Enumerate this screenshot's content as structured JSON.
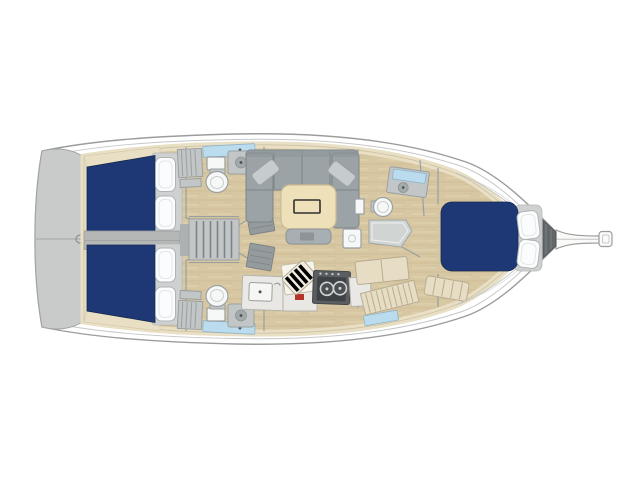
{
  "canvas": {
    "width_px": 640,
    "height_px": 479,
    "background": "#ffffff"
  },
  "colors": {
    "hull-line": "#9b9d9c",
    "deck-line": "#c6c8c7",
    "transom": "#c9cbcb",
    "transom-line": "#a2a4a4",
    "cream": "#e9dfc4",
    "cream-line": "#cdc2a3",
    "wood": "#d8c7a3",
    "wood-dark": "#c8b38b",
    "wood-light": "#e4d6b4",
    "navy": "#1d3874",
    "navy-edge": "#15294f",
    "pillow": "#fbfcfd",
    "pillow-line": "#aeb4b6",
    "gray-furn": "#c3c6c7",
    "gray-furn-line": "#9aa0a0",
    "cushion": "#9ba3a7",
    "cushion-line": "#7c8589",
    "cushion-light": "#c6cccd",
    "table": "#eee0b9",
    "table-line": "#cdbd8e",
    "white-fix": "#f6f7f7",
    "fix-line": "#9aa0a2",
    "counter": "#e9e8e4",
    "counter-line": "#b3b3ae",
    "stove": "#5a5e60",
    "stove-dark": "#3e4244",
    "stove-line": "#d2d5d6",
    "blue-glass": "#badcee",
    "blue-glass-line": "#8fb4c9",
    "beige-furn": "#e7ddc4",
    "beige-furn-line": "#b8ad92",
    "mat": "#949b9d",
    "mat-line": "#7d8486",
    "locker-dark": "#626769",
    "red-tag": "#b5352a",
    "divider": "#b5b7b7"
  },
  "floorplan": {
    "subject": "sailing-yacht-interior-layout",
    "view": "top-down deck plan",
    "orientation": "bow-right, stern-left",
    "areas": [
      {
        "name": "swim-platform-transom"
      },
      {
        "name": "aft-cabin-port",
        "berth_color": "navy",
        "pillows": 2
      },
      {
        "name": "aft-cabin-starboard",
        "berth_color": "navy",
        "pillows": 2
      },
      {
        "name": "companionway-stairs",
        "treads": 6
      },
      {
        "name": "head-port",
        "fixtures": [
          "toilet",
          "sink",
          "shower-mat",
          "hatch"
        ]
      },
      {
        "name": "head-starboard",
        "fixtures": [
          "toilet",
          "sink",
          "shower-mat",
          "hatch"
        ]
      },
      {
        "name": "salon",
        "fixtures": [
          "u-settee",
          "folding-table",
          "bench",
          "throw-pillows"
        ]
      },
      {
        "name": "galley",
        "fixtures": [
          "sink",
          "stove-2-burner",
          "striped-cutting-board",
          "counters"
        ]
      },
      {
        "name": "forward-head",
        "fixtures": [
          "toilet",
          "vanity-sink",
          "shower-pan"
        ]
      },
      {
        "name": "forward-cabin",
        "berth_color": "navy",
        "pillows": 2
      },
      {
        "name": "anchor-locker"
      },
      {
        "name": "bowsprit"
      }
    ]
  }
}
